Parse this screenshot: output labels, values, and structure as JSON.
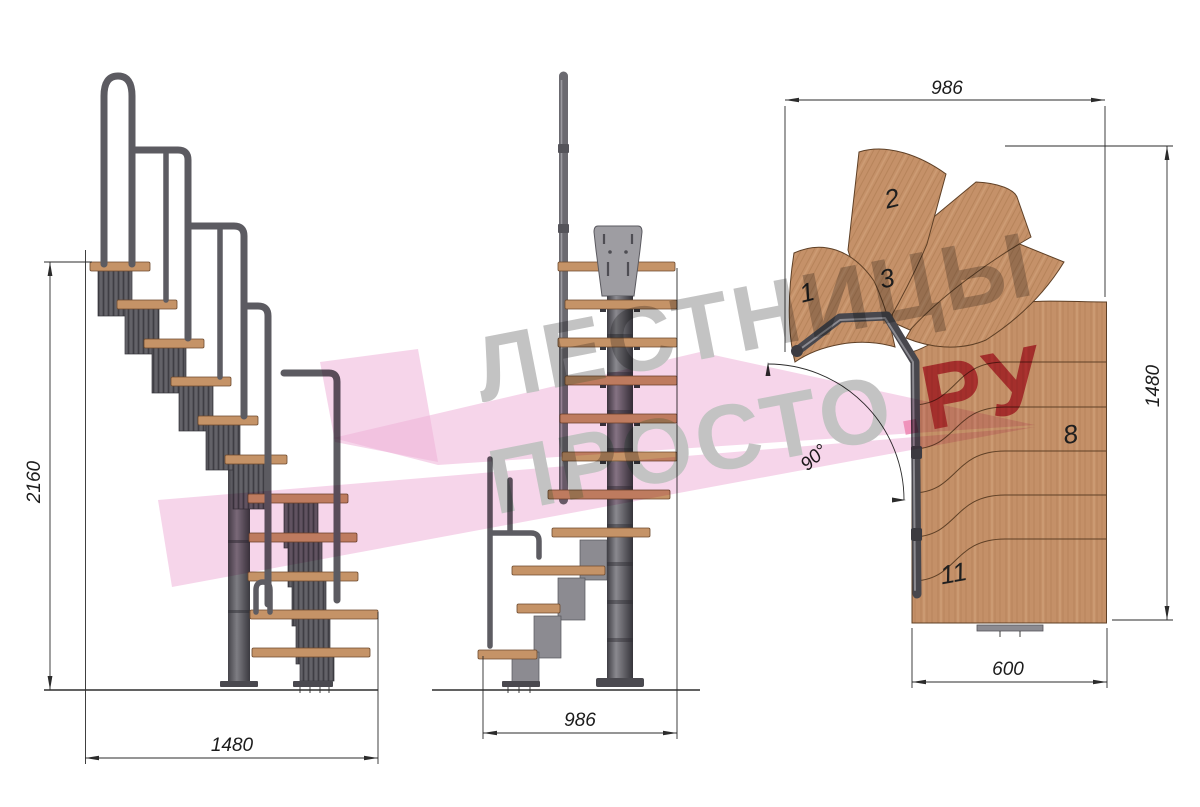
{
  "drawing": {
    "type": "modular-staircase-technical-drawing",
    "views": {
      "side": {
        "height_mm": "2160",
        "run_mm": "1480"
      },
      "front": {
        "width_mm": "986"
      },
      "plan": {
        "width_mm": "986",
        "depth_mm": "1480",
        "exit_width_mm": "600",
        "turn_angle": "90°",
        "step_numbers": {
          "n1": "1",
          "n2": "2",
          "n3": "3",
          "n8": "8",
          "n11": "11"
        }
      }
    }
  },
  "watermark": {
    "line1": "ЛЕСТНИЦЫ",
    "line2": "ПРОСТО",
    "dot": ".",
    "tld": "РУ"
  },
  "colors": {
    "wood": "#c49068",
    "wood_outline": "#5f4026",
    "metal_dark": "#56555b",
    "metal_light": "#8c8b91",
    "dim_line": "#2b2b2b",
    "watermark_gray": "#c3c3c3",
    "watermark_red": "#d5536b",
    "watermark_dot_pink": "#ef93bb",
    "logo_pink": "#eeb2d8"
  }
}
